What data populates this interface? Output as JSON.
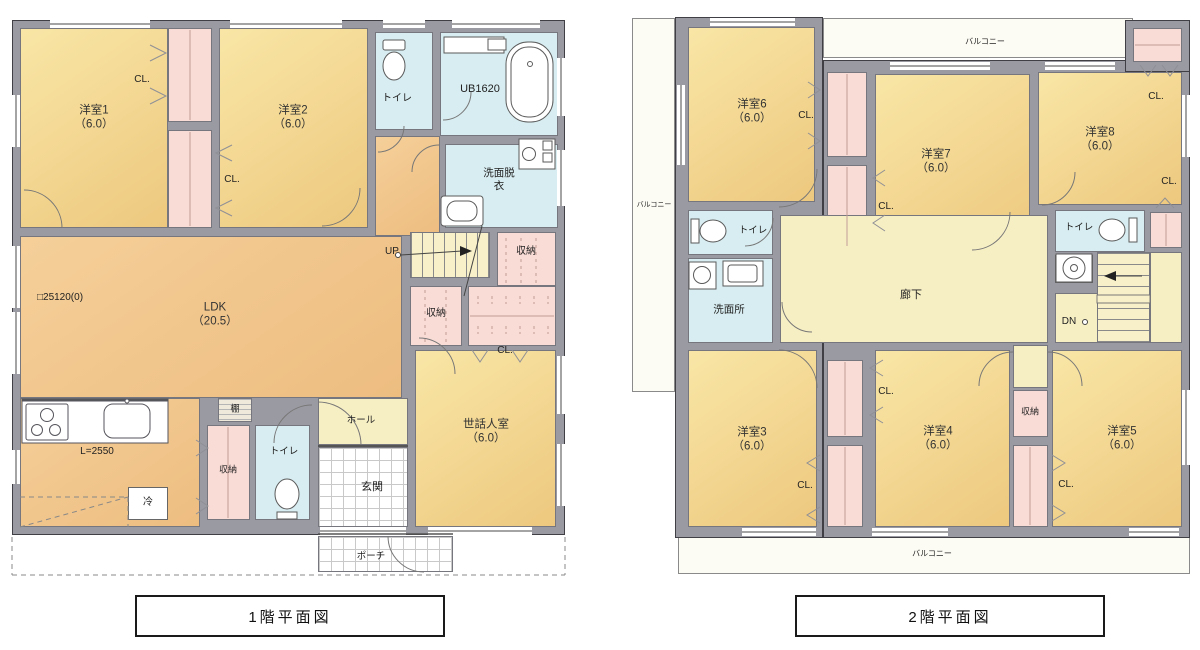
{
  "common": {
    "closet": "CL.",
    "storage": "収納",
    "toilet": "トイレ",
    "balcony": "バルコニー"
  },
  "floor1": {
    "title": "1階平面図",
    "rooms": {
      "bedroom1": {
        "name": "洋室1",
        "area": "（6.0）"
      },
      "bedroom2": {
        "name": "洋室2",
        "area": "（6.0）"
      },
      "ldk": {
        "name": "LDK",
        "area": "（20.5）"
      },
      "caretaker_room": {
        "name": "世話人室",
        "area": "（6.0）"
      },
      "unit_bath": "UB1620",
      "washroom": "洗面脱衣",
      "hall": "ホール",
      "entrance": "玄関",
      "porch": "ポーチ",
      "shelf": "棚",
      "fridge": "冷"
    },
    "annotations": {
      "grid_note": "□25120(0)",
      "counter_length": "L=2550",
      "stairs_up": "UP"
    }
  },
  "floor2": {
    "title": "2階平面図",
    "rooms": {
      "bedroom3": {
        "name": "洋室3",
        "area": "（6.0）"
      },
      "bedroom4": {
        "name": "洋室4",
        "area": "（6.0）"
      },
      "bedroom5": {
        "name": "洋室5",
        "area": "（6.0）"
      },
      "bedroom6": {
        "name": "洋室6",
        "area": "（6.0）"
      },
      "bedroom7": {
        "name": "洋室7",
        "area": "（6.0）"
      },
      "bedroom8": {
        "name": "洋室8",
        "area": "（6.0）"
      },
      "corridor": "廊下",
      "washroom": "洗面所"
    },
    "annotations": {
      "stairs_down": "DN"
    }
  }
}
